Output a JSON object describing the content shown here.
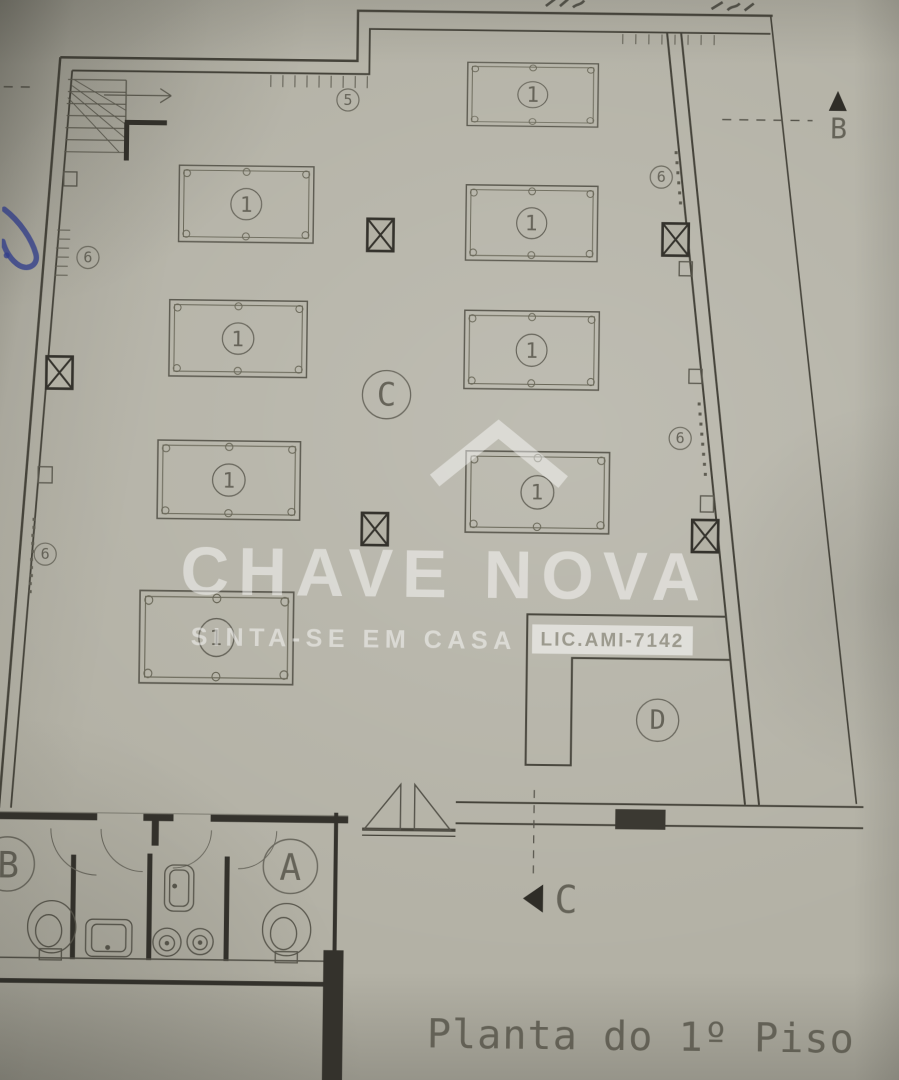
{
  "title": {
    "text": "Planta do 1º Piso"
  },
  "watermark": {
    "brand": "CHAVE NOVA",
    "tagline": "SINTA-SE EM CASA",
    "license": "LIC.AMI-7142"
  },
  "labels": {
    "table": "1",
    "count_5": "5",
    "count_6": "6",
    "zone_c": "C",
    "zone_d": "D",
    "wc_a": "A",
    "wc_b": "B",
    "section_b": "B",
    "section_c": "C"
  },
  "plan_summary": {
    "billiard_table_markers": 8,
    "column_markers": 5
  },
  "colors": {
    "paper": "#b3b1a5",
    "ink": "#3b3932",
    "thin_line": "#5f5d52",
    "pen_annotation": "#35418f",
    "watermark_white": "#ffffff"
  }
}
